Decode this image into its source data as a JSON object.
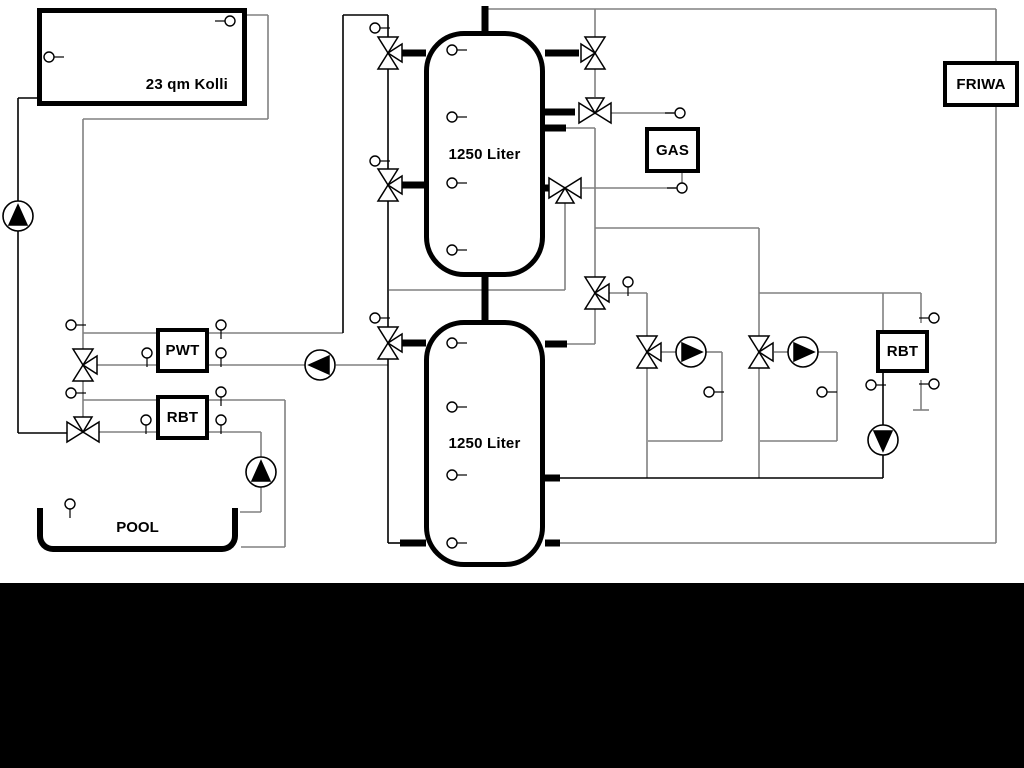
{
  "labels": {
    "collector": "23 qm Kolli",
    "tank_top": "1250 Liter",
    "tank_bottom": "1250 Liter",
    "pwt": "PWT",
    "rbt_left": "RBT",
    "gas": "GAS",
    "friwa": "FRIWA",
    "rbt_right": "RBT",
    "pool": "POOL"
  },
  "colors": {
    "line_black": "#000000",
    "line_gray": "#808080",
    "background": "#ffffff",
    "letterbox": "#000000"
  },
  "geometry": {
    "pipes_black": [
      [
        18,
        98,
        18,
        433
      ],
      [
        18,
        98,
        37,
        98
      ],
      [
        18,
        433,
        67,
        433
      ],
      [
        343,
        333,
        343,
        15
      ],
      [
        343,
        15,
        388,
        15
      ],
      [
        388,
        15,
        388,
        37
      ],
      [
        388,
        69,
        388,
        169
      ],
      [
        388,
        201,
        388,
        327
      ],
      [
        388,
        359,
        388,
        543
      ],
      [
        388,
        543,
        402,
        543
      ],
      [
        559,
        478,
        883,
        478
      ],
      [
        883,
        373,
        883,
        425
      ],
      [
        883,
        455,
        883,
        478
      ]
    ],
    "pipes_gray": [
      [
        247,
        15,
        268,
        15
      ],
      [
        268,
        15,
        268,
        119
      ],
      [
        83,
        119,
        268,
        119
      ],
      [
        83,
        119,
        83,
        417
      ],
      [
        83,
        333,
        156,
        333
      ],
      [
        97,
        365,
        156,
        365
      ],
      [
        83,
        400,
        156,
        400
      ],
      [
        99,
        432,
        156,
        432
      ],
      [
        209,
        333,
        343,
        333
      ],
      [
        209,
        365,
        305,
        365
      ],
      [
        336,
        365,
        388,
        365
      ],
      [
        209,
        400,
        285,
        400
      ],
      [
        285,
        400,
        285,
        547
      ],
      [
        285,
        547,
        241,
        547
      ],
      [
        209,
        432,
        261,
        432
      ],
      [
        261,
        432,
        261,
        457
      ],
      [
        261,
        487,
        261,
        512
      ],
      [
        261,
        512,
        240,
        512
      ],
      [
        485,
        9,
        996,
        9
      ],
      [
        996,
        9,
        996,
        61
      ],
      [
        996,
        107,
        996,
        543
      ],
      [
        996,
        543,
        559,
        543
      ],
      [
        595,
        9,
        595,
        37
      ],
      [
        595,
        69,
        595,
        97
      ],
      [
        611,
        113,
        674,
        113
      ],
      [
        582,
        188,
        676,
        188
      ],
      [
        682,
        173,
        682,
        183
      ],
      [
        565,
        203,
        565,
        290
      ],
      [
        389,
        290,
        565,
        290
      ],
      [
        565,
        128,
        595,
        128
      ],
      [
        595,
        128,
        595,
        277
      ],
      [
        595,
        228,
        759,
        228
      ],
      [
        759,
        228,
        759,
        336
      ],
      [
        759,
        293,
        921,
        293
      ],
      [
        609,
        293,
        647,
        293
      ],
      [
        647,
        293,
        647,
        336
      ],
      [
        595,
        309,
        595,
        344
      ],
      [
        567,
        344,
        595,
        344
      ],
      [
        647,
        368,
        647,
        478
      ],
      [
        661,
        352,
        676,
        352
      ],
      [
        706,
        352,
        722,
        352
      ],
      [
        722,
        352,
        722,
        441
      ],
      [
        722,
        441,
        648,
        441
      ],
      [
        774,
        352,
        788,
        352
      ],
      [
        818,
        352,
        837,
        352
      ],
      [
        837,
        352,
        837,
        441
      ],
      [
        837,
        441,
        760,
        441
      ],
      [
        759,
        368,
        759,
        478
      ],
      [
        883,
        293,
        883,
        330
      ],
      [
        921,
        293,
        921,
        323
      ],
      [
        921,
        380,
        921,
        410
      ],
      [
        913,
        410,
        929,
        410
      ]
    ],
    "stubs": [
      [
        485,
        6,
        485,
        31
      ],
      [
        485,
        277,
        485,
        320
      ],
      [
        402,
        53,
        426,
        53
      ],
      [
        402,
        185,
        426,
        185
      ],
      [
        402,
        343,
        426,
        343
      ],
      [
        545,
        53,
        579,
        53
      ],
      [
        545,
        112,
        575,
        112
      ],
      [
        545,
        128,
        566,
        128
      ],
      [
        545,
        188,
        550,
        188
      ],
      [
        545,
        344,
        567,
        344
      ],
      [
        545,
        478,
        560,
        478
      ],
      [
        545,
        543,
        560,
        543
      ],
      [
        400,
        543,
        426,
        543
      ]
    ],
    "valves": [
      [
        388,
        53,
        "v",
        "aR"
      ],
      [
        388,
        185,
        "v",
        "aR"
      ],
      [
        388,
        343,
        "v",
        "aR"
      ],
      [
        83,
        365,
        "v",
        "aR"
      ],
      [
        83,
        432,
        "h",
        "bT"
      ],
      [
        595,
        53,
        "v",
        "aL"
      ],
      [
        595,
        113,
        "h",
        "bT"
      ],
      [
        565,
        188,
        "h",
        "bB"
      ],
      [
        595,
        293,
        "v",
        "aR"
      ],
      [
        647,
        352,
        "v",
        "aR"
      ],
      [
        759,
        352,
        "v",
        "aR"
      ]
    ],
    "pumps": [
      [
        18,
        216,
        "up"
      ],
      [
        261,
        472,
        "up"
      ],
      [
        320,
        365,
        "left"
      ],
      [
        691,
        352,
        "right"
      ],
      [
        803,
        352,
        "right"
      ],
      [
        883,
        440,
        "down"
      ]
    ],
    "sensors": [
      [
        49,
        57,
        "r"
      ],
      [
        230,
        21,
        "l"
      ],
      [
        71,
        325,
        "r"
      ],
      [
        71,
        393,
        "r"
      ],
      [
        147,
        353,
        "d"
      ],
      [
        146,
        420,
        "d"
      ],
      [
        221,
        325,
        "d"
      ],
      [
        221,
        353,
        "d"
      ],
      [
        221,
        392,
        "d"
      ],
      [
        221,
        420,
        "d"
      ],
      [
        70,
        504,
        "d"
      ],
      [
        375,
        28,
        "r"
      ],
      [
        375,
        161,
        "r"
      ],
      [
        375,
        318,
        "r"
      ],
      [
        452,
        50,
        "r"
      ],
      [
        452,
        117,
        "r"
      ],
      [
        452,
        183,
        "r"
      ],
      [
        452,
        250,
        "r"
      ],
      [
        452,
        343,
        "r"
      ],
      [
        452,
        407,
        "r"
      ],
      [
        452,
        475,
        "r"
      ],
      [
        452,
        543,
        "r"
      ],
      [
        628,
        282,
        "d"
      ],
      [
        709,
        392,
        "r"
      ],
      [
        822,
        392,
        "r"
      ],
      [
        871,
        385,
        "r"
      ],
      [
        934,
        318,
        "l"
      ],
      [
        934,
        384,
        "l"
      ],
      [
        680,
        113,
        "l"
      ],
      [
        682,
        188,
        "l"
      ]
    ]
  }
}
